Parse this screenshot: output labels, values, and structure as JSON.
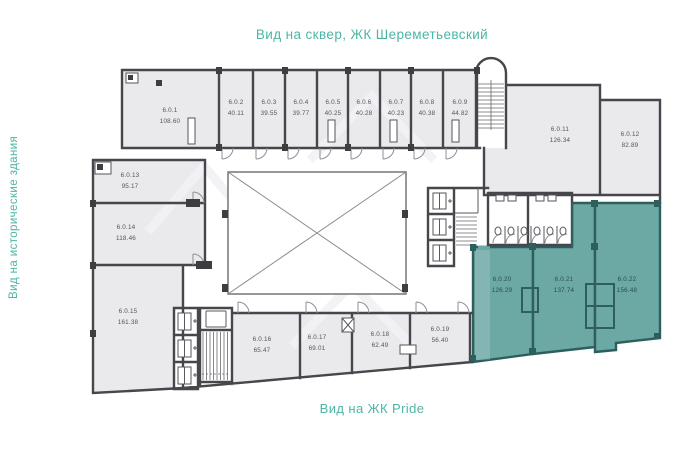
{
  "titles": {
    "top": "Вид на сквер, ЖК Шереметьевский",
    "left": "Вид на исторические здания",
    "bottom": "Вид на ЖК Pride"
  },
  "colors": {
    "accent_teal_text": "#4db5a5",
    "unit_fill": "#eaeaed",
    "highlight_unit_fill": "#6ca8a4",
    "highlight_wall": "#2e5f5c",
    "wall": "#47474b",
    "unit_label": "#54545a"
  },
  "units": [
    {
      "id": "6.0.1",
      "area": "108.60",
      "highlighted": false
    },
    {
      "id": "6.0.2",
      "area": "40.11",
      "highlighted": false
    },
    {
      "id": "6.0.3",
      "area": "39.55",
      "highlighted": false
    },
    {
      "id": "6.0.4",
      "area": "39.77",
      "highlighted": false
    },
    {
      "id": "6.0.5",
      "area": "40.25",
      "highlighted": false
    },
    {
      "id": "6.0.6",
      "area": "40.28",
      "highlighted": false
    },
    {
      "id": "6.0.7",
      "area": "40.23",
      "highlighted": false
    },
    {
      "id": "6.0.8",
      "area": "40.38",
      "highlighted": false
    },
    {
      "id": "6.0.9",
      "area": "44.82",
      "highlighted": false
    },
    {
      "id": "6.0.11",
      "area": "126.34",
      "highlighted": false
    },
    {
      "id": "6.0.12",
      "area": "82.89",
      "highlighted": false
    },
    {
      "id": "6.0.13",
      "area": "95.17",
      "highlighted": false
    },
    {
      "id": "6.0.14",
      "area": "118.46",
      "highlighted": false
    },
    {
      "id": "6.0.15",
      "area": "161.38",
      "highlighted": false
    },
    {
      "id": "6.0.16",
      "area": "65.47",
      "highlighted": false
    },
    {
      "id": "6.0.17",
      "area": "69.01",
      "highlighted": false
    },
    {
      "id": "6.0.18",
      "area": "62.49",
      "highlighted": false
    },
    {
      "id": "6.0.19",
      "area": "56.40",
      "highlighted": false
    },
    {
      "id": "6.0.20",
      "area": "126.29",
      "highlighted": true
    },
    {
      "id": "6.0.21",
      "area": "137.74",
      "highlighted": true
    },
    {
      "id": "6.0.22",
      "area": "156.48",
      "highlighted": true
    }
  ]
}
